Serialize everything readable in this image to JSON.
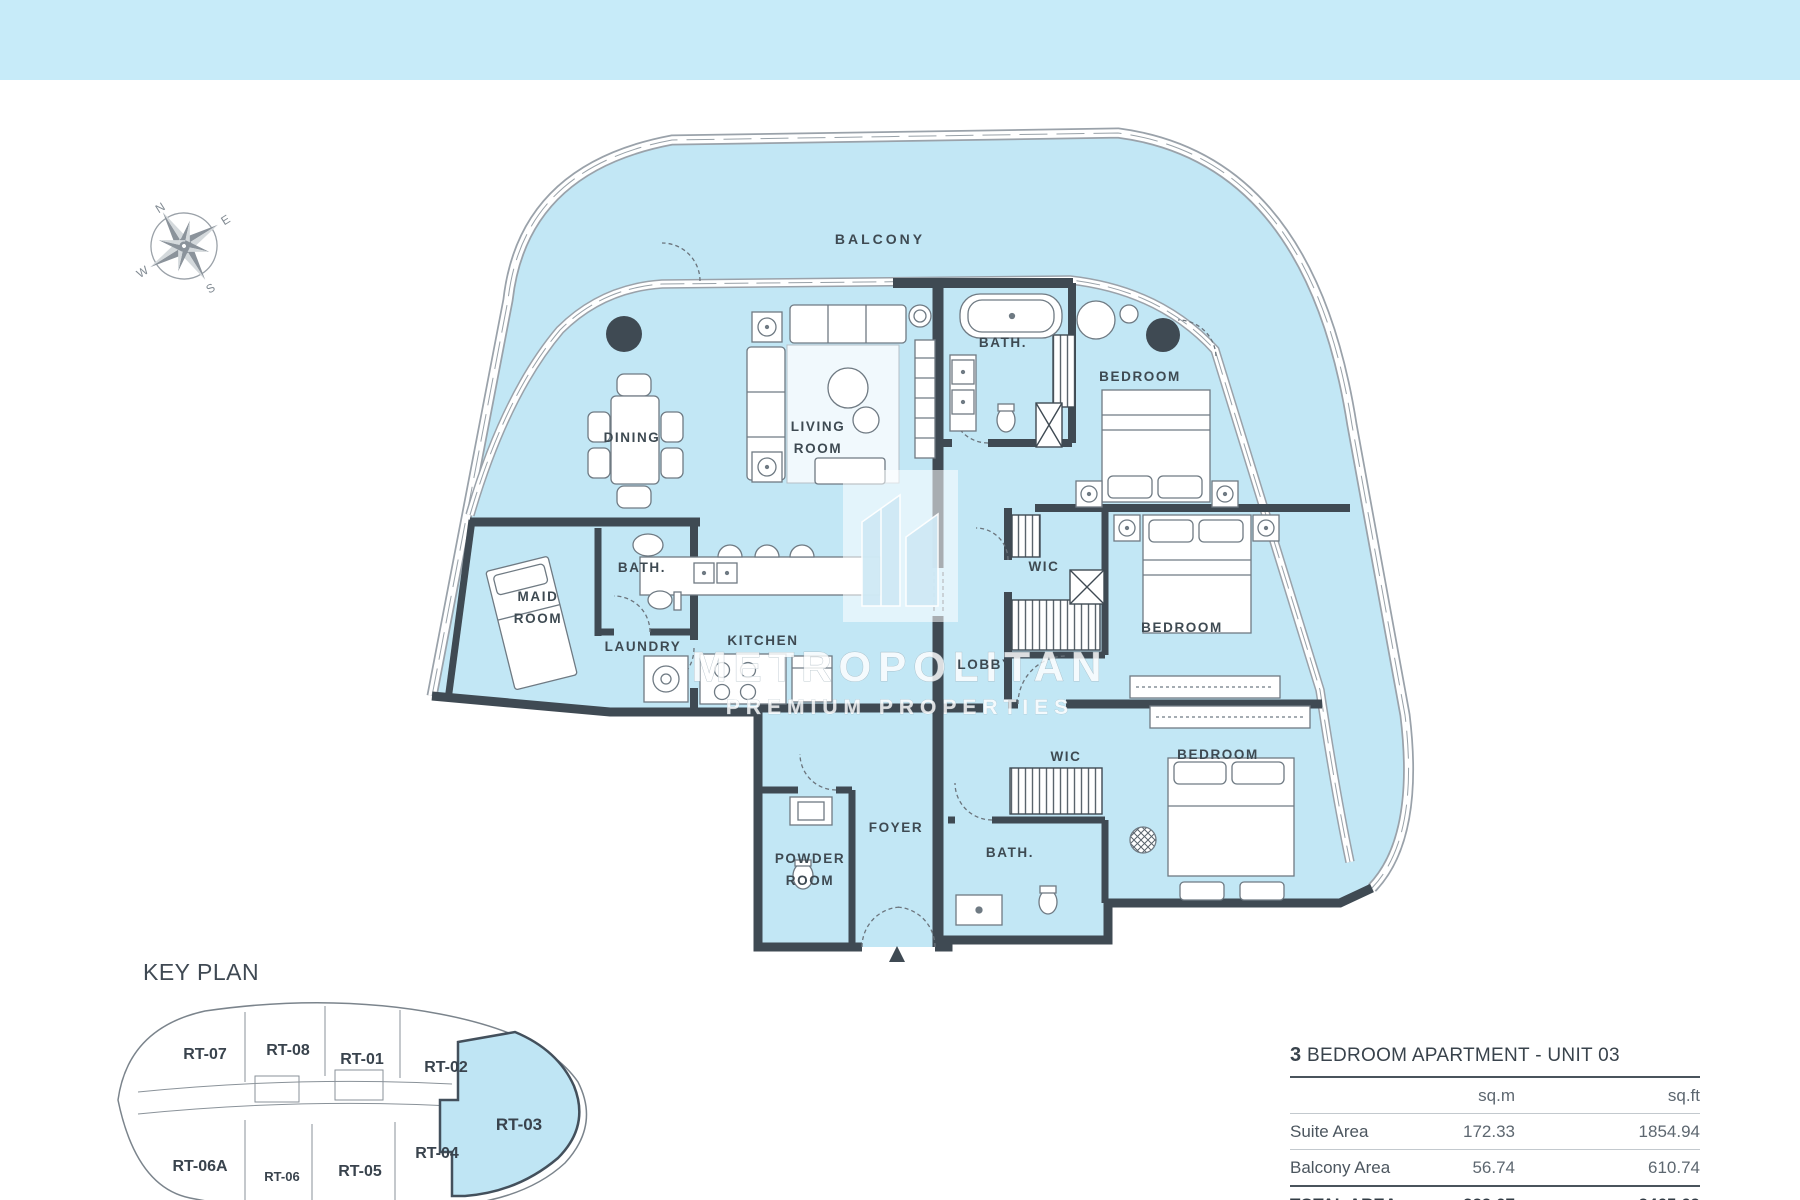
{
  "theme": {
    "top_bar_color": "#c7ebf9",
    "plan_fill_color": "#c2e7f5",
    "wall_color": "#3f4a53",
    "keyplan_highlight_color": "#bfe5f4"
  },
  "compass": {
    "directions": {
      "north": "N",
      "east": "E",
      "south": "S",
      "west": "W"
    }
  },
  "floor_plan": {
    "fill_color": "#c2e7f5",
    "wall_color": "#3f4a53",
    "entrance_icon": "up-triangle",
    "rooms": [
      {
        "id": "balcony",
        "lines": [
          "BALCONY"
        ]
      },
      {
        "id": "dining",
        "lines": [
          "DINING"
        ]
      },
      {
        "id": "living-room",
        "lines": [
          "LIVING",
          "ROOM"
        ]
      },
      {
        "id": "bath-master",
        "lines": [
          "BATH."
        ]
      },
      {
        "id": "bedroom-1",
        "lines": [
          "BEDROOM"
        ]
      },
      {
        "id": "maid-room",
        "lines": [
          "MAID",
          "ROOM"
        ]
      },
      {
        "id": "bath-maid",
        "lines": [
          "BATH."
        ]
      },
      {
        "id": "laundry",
        "lines": [
          "LAUNDRY"
        ]
      },
      {
        "id": "kitchen",
        "lines": [
          "KITCHEN"
        ]
      },
      {
        "id": "wic-1",
        "lines": [
          "WIC"
        ]
      },
      {
        "id": "lobby",
        "lines": [
          "LOBBY"
        ]
      },
      {
        "id": "bedroom-2",
        "lines": [
          "BEDROOM"
        ]
      },
      {
        "id": "wic-2",
        "lines": [
          "WIC"
        ]
      },
      {
        "id": "bedroom-3",
        "lines": [
          "BEDROOM"
        ]
      },
      {
        "id": "foyer",
        "lines": [
          "FOYER"
        ]
      },
      {
        "id": "powder-room",
        "lines": [
          "POWDER",
          "ROOM"
        ]
      },
      {
        "id": "bath-2",
        "lines": [
          "BATH."
        ]
      }
    ]
  },
  "watermark": {
    "title": "METROPOLITAN",
    "subtitle": "PREMIUM PROPERTIES"
  },
  "key_plan": {
    "title": "KEY PLAN",
    "highlighted_unit": "RT-03",
    "units": [
      {
        "id": "RT-07"
      },
      {
        "id": "RT-08"
      },
      {
        "id": "RT-01"
      },
      {
        "id": "RT-02"
      },
      {
        "id": "RT-03"
      },
      {
        "id": "RT-04"
      },
      {
        "id": "RT-05"
      },
      {
        "id": "RT-06"
      },
      {
        "id": "RT-06A"
      }
    ]
  },
  "area_table": {
    "title_number": "3",
    "title_text": "BEDROOM APARTMENT - UNIT 03",
    "columns": {
      "col1": "",
      "col2": "sq.m",
      "col3": "sq.ft"
    },
    "rows": [
      {
        "label": "Suite Area",
        "sqm": "172.33",
        "sqft": "1854.94"
      },
      {
        "label": "Balcony Area",
        "sqm": "56.74",
        "sqft": "610.74"
      }
    ],
    "total": {
      "label": "TOTAL AREA",
      "sqm": "229.07",
      "sqft": "2465.69"
    }
  }
}
